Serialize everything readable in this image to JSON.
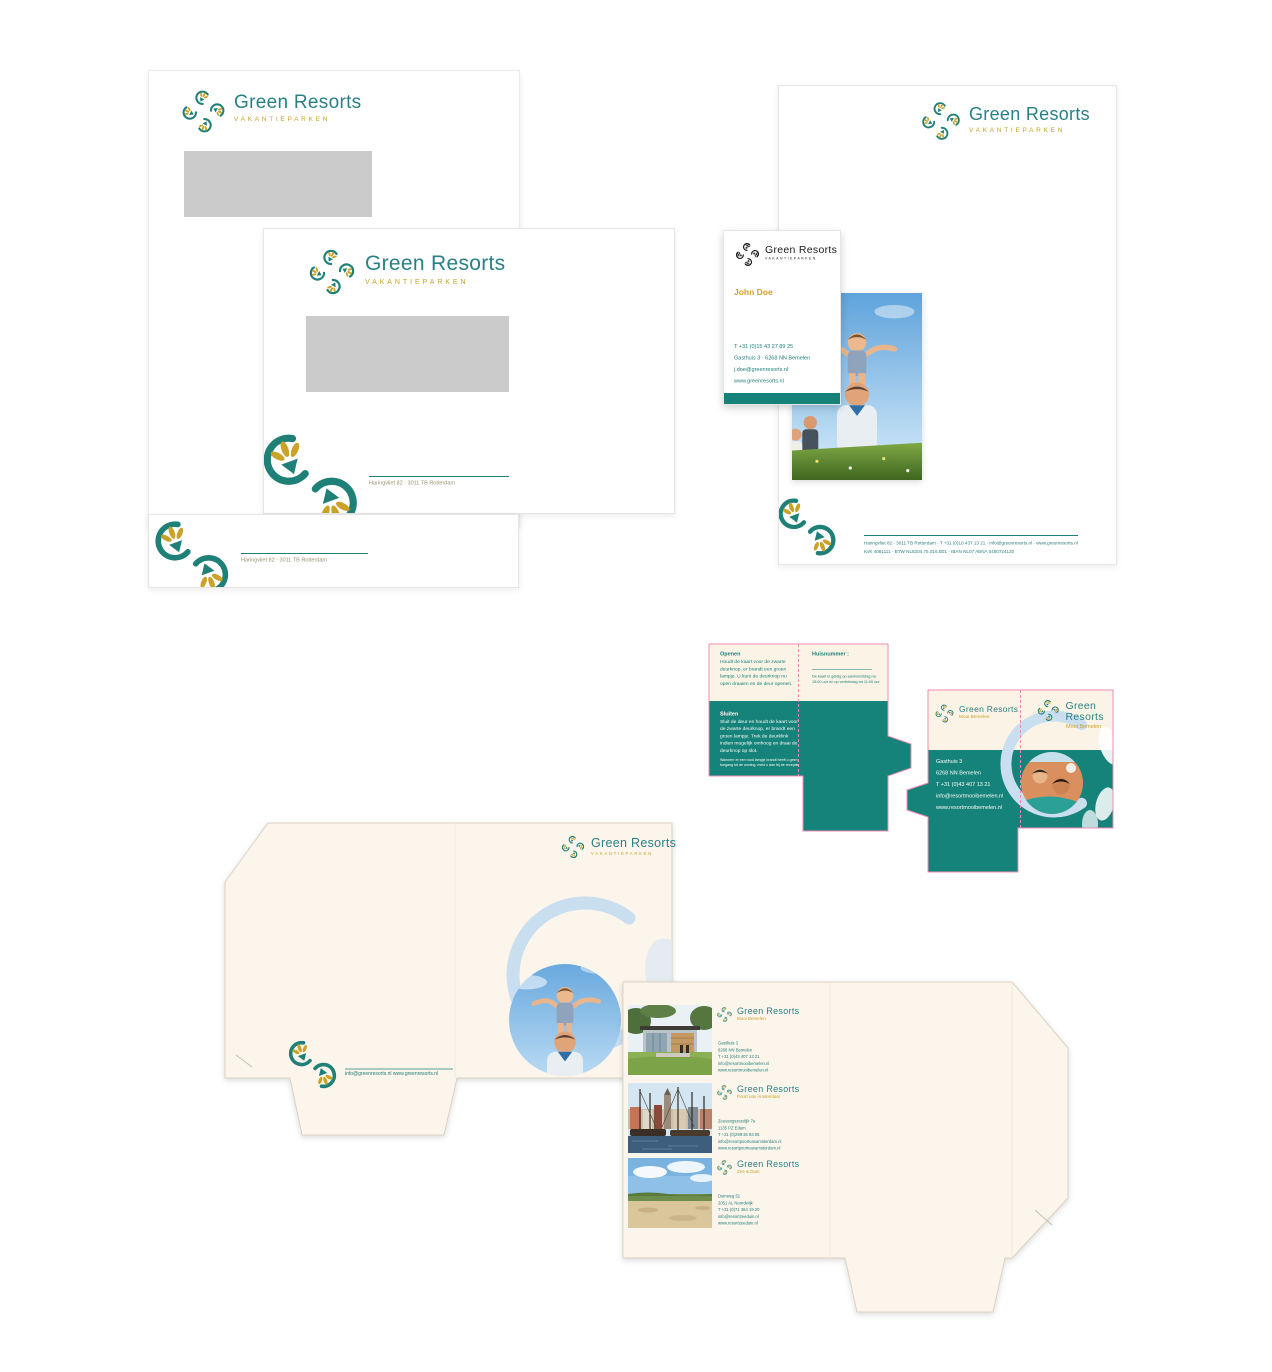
{
  "brand": {
    "name": "Green Resorts",
    "tagline": "VAKANTIEPARKEN",
    "teal": "#1F8078",
    "gold": "#C9A227",
    "cream": "#FBF3E6",
    "diecut_pink": "#F08CB4",
    "swirl_blue": "#C9DFF0",
    "window_gray": "#CBCBCB"
  },
  "stationery": {
    "envelope_address": "Haringvliet 82 · 3011 TB Rotterdam",
    "letterhead_footer_line1": "Haringvliet 82 · 3011 TB Rotterdam · T +31 (0)10 437 13 21 · info@greenresorts.nl · www.greenresorts.nl",
    "letterhead_footer_line2": "KvK 4081111 · BTW NL8204.75.016.B01 · IBAN NL07 ABNA 0460724130"
  },
  "business_card": {
    "person": "John Doe",
    "phone": "T +31 (0)15 43 27 89 25",
    "address": "Gasthuis 3 · 6268 NN  Bemelen",
    "email": "j.doe@greenresorts.nl",
    "website": "www.greenresorts.nl"
  },
  "keycard": {
    "open_title": "Openen",
    "open_body": "Houdt de kaart voor de zwarte deurknop, er brandt een groen lampje. U kunt de deurknop nu open draaien en de deur openen.",
    "room_number_label": "Huisnummer :",
    "validity_note": "De kaart is geldig op aankomstdag na 15:00 uur en op vertrekdag tot 11:00 uur",
    "close_title": "Sluiten",
    "close_body": "Sluit de deur en houdt de kaart voor de zwarte deurknop, er brandt een groen lampje. Trek de deurklink indien mogelijk omhoog en draai de deurknop op slot.",
    "close_note": "Wanneer er een rood lampje brandt heeft u geen toegang tot de woning, meld u dan bij de receptie."
  },
  "resort_card": {
    "subtitle": "Mooi Bemelen",
    "address1": "Gasthuis 3",
    "address2": "6268 NN  Bemelen",
    "phone": "T +31 (0)43 407 13 21",
    "email": "info@resortmooibemelen.nl",
    "website": "www.resortmooibemelen.nl"
  },
  "folder": {
    "front_contact": "info@greenresorts.nl     www.greenresorts.nl",
    "resorts": [
      {
        "subtitle": "Mooi Bemelen",
        "address1": "Gasthuis 3",
        "address2": "6268 NN  Bemelen",
        "phone": "T +31 (0)43 407 13 21",
        "email": "info@resortmooibemelen.nl",
        "website": "www.resortmooibemelen.nl"
      },
      {
        "subtitle": "Poort van Amsterdam",
        "address1": "Zeevangszeedijk 7a",
        "address2": "1135 PZ  Edam",
        "phone": "T +31 (0)299 36 93 05",
        "email": "info@resortpoortvanamsterdam.nl",
        "website": "www.resortpoortvanamsterdam.nl"
      },
      {
        "subtitle": "Zee & Duin",
        "address1": "Duinweg 51",
        "address2": "2051 AL  Noordwijk",
        "phone": "T +31 (0)71 364 19 20",
        "email": "info@resortzeeduin.nl",
        "website": "www.resortzeeduin.nl"
      }
    ]
  }
}
